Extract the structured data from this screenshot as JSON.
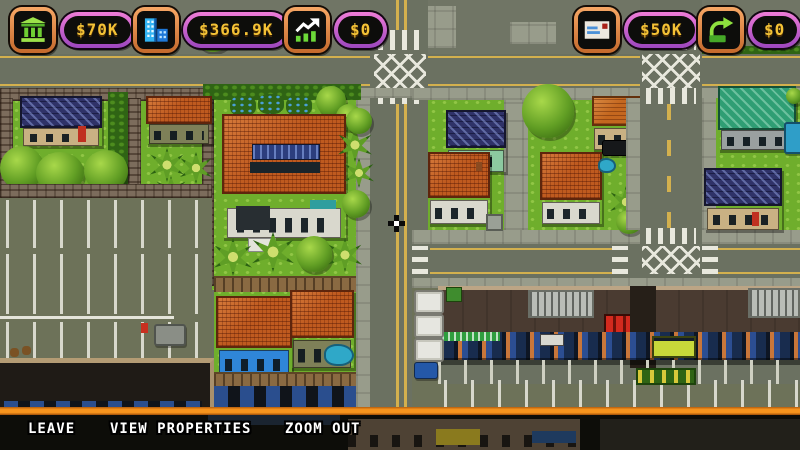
{
  "hud": {
    "counters": [
      {
        "id": "cash",
        "icon": "bank-icon",
        "value": "$70K"
      },
      {
        "id": "property-value",
        "icon": "buildings-icon",
        "value": "$366.9K"
      },
      {
        "id": "revenue",
        "icon": "chart-up-icon",
        "value": "$0"
      },
      {
        "id": "mail-money",
        "icon": "envelope-icon",
        "value": "$50K"
      },
      {
        "id": "transfer",
        "icon": "wallet-arrow-icon",
        "value": "$0"
      }
    ],
    "colors": {
      "icon_border": "#f7a765",
      "pill_border": "#ef7cd8",
      "value_text": "#f4c236"
    }
  },
  "menu": {
    "items": [
      {
        "id": "leave",
        "label": "LEAVE"
      },
      {
        "id": "view-properties",
        "label": "VIEW PROPERTIES"
      },
      {
        "id": "zoom-out",
        "label": "ZOOM OUT"
      }
    ],
    "separator_color": "#f7941d"
  }
}
